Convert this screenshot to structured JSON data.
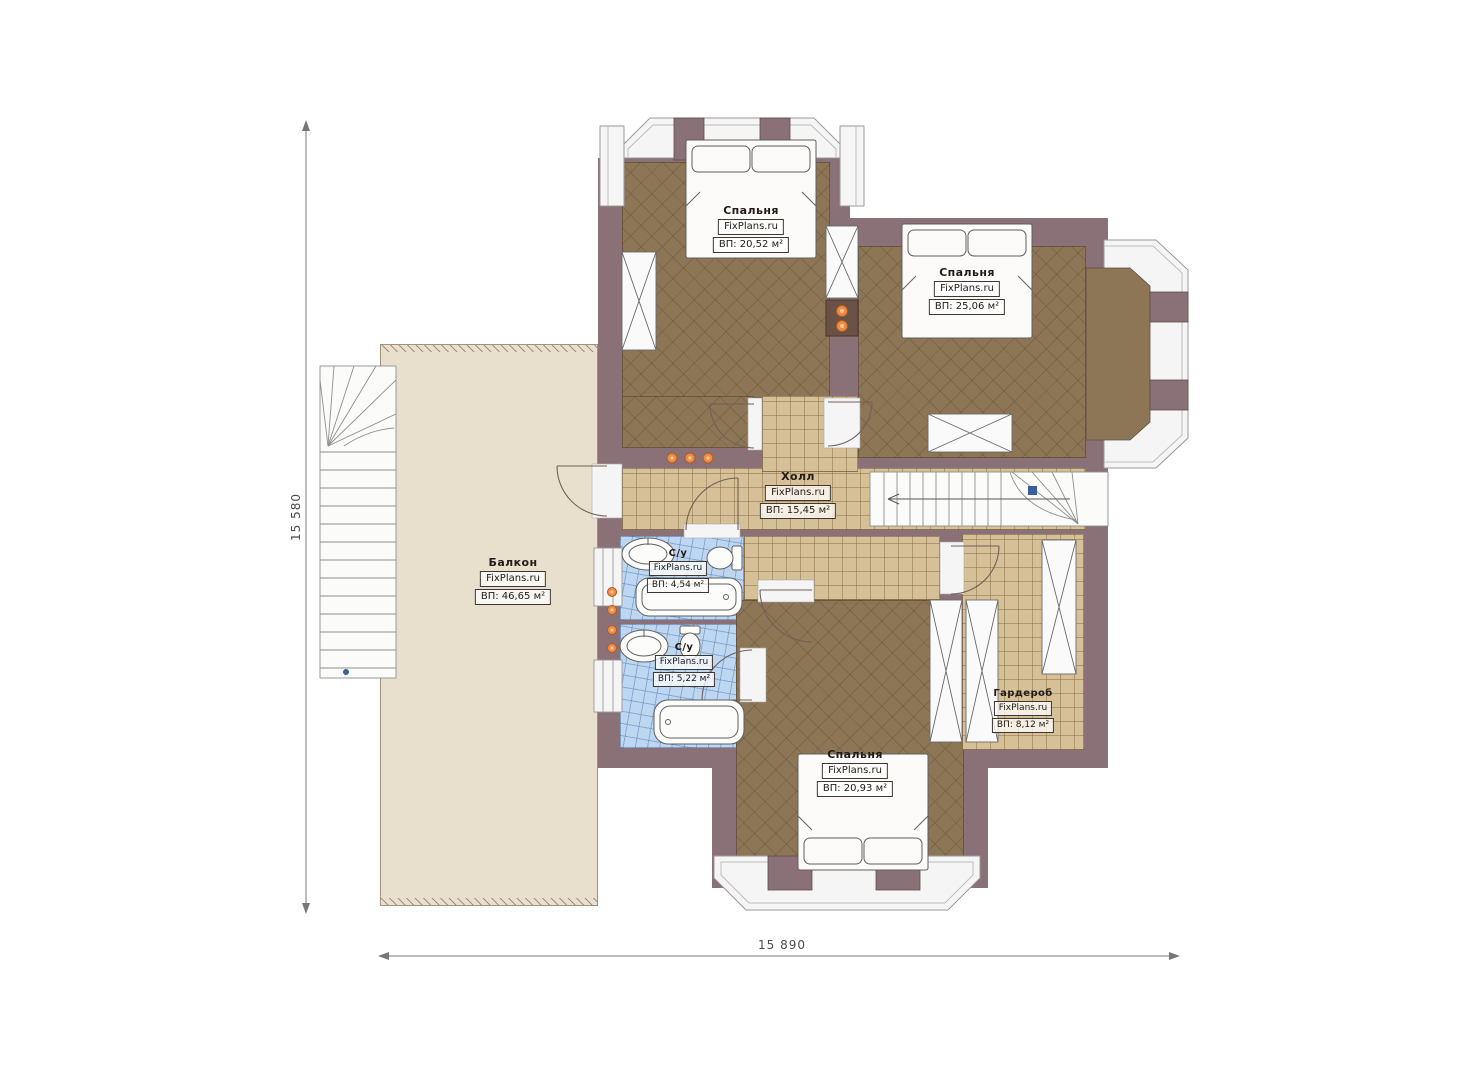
{
  "plan": {
    "dimensions": {
      "vertical": "15 580",
      "horizontal": "15 890"
    },
    "rooms": [
      {
        "id": "bedroom-top-left",
        "name": "Спальня",
        "brand": "FixPlans.ru",
        "area": "ВП: 20,52 м²"
      },
      {
        "id": "bedroom-top-right",
        "name": "Спальня",
        "brand": "FixPlans.ru",
        "area": "ВП: 25,06 м²"
      },
      {
        "id": "hall",
        "name": "Холл",
        "brand": "FixPlans.ru",
        "area": "ВП: 15,45 м²"
      },
      {
        "id": "balcony",
        "name": "Балкон",
        "brand": "FixPlans.ru",
        "area": "ВП: 46,65 м²"
      },
      {
        "id": "bathroom-1",
        "name": "С/у",
        "brand": "FixPlans.ru",
        "area": "ВП: 4,54 м²"
      },
      {
        "id": "bathroom-2",
        "name": "С/у",
        "brand": "FixPlans.ru",
        "area": "ВП: 5,22 м²"
      },
      {
        "id": "wardrobe-room",
        "name": "Гардероб",
        "brand": "FixPlans.ru",
        "area": "ВП: 8,12 м²"
      },
      {
        "id": "bedroom-bottom",
        "name": "Спальня",
        "brand": "FixPlans.ru",
        "area": "ВП: 20,93 м²"
      }
    ],
    "colors": {
      "wall": "#8a7077",
      "bedroom_floor": "#8d7656",
      "tile_floor": "#d6c097",
      "bath_tile": "#bdd7f2",
      "balcony": "#e8e0cd",
      "accent_dots": "#ee8c44",
      "marker_blue": "#3a5fa0"
    }
  }
}
